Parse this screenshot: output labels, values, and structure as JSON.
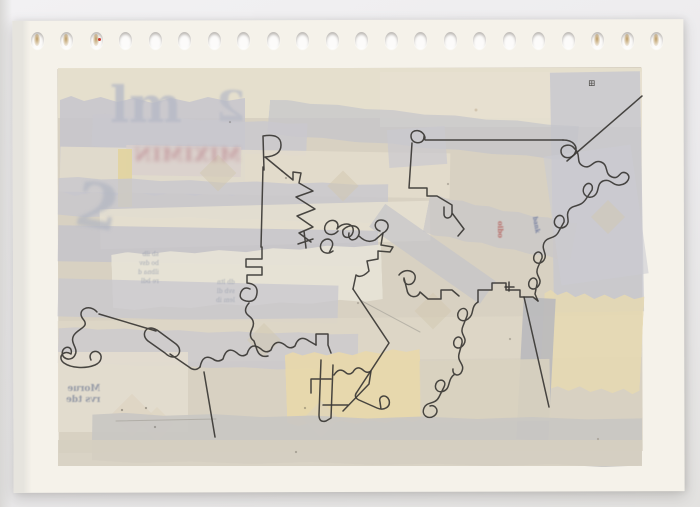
{
  "photo": {
    "bg_top": "#f2f1f3",
    "bg_bottom": "#e3e2e0"
  },
  "sheet": {
    "x": 13,
    "y": 20,
    "w": 671,
    "h": 472,
    "color": "#f5f2ea",
    "band_x": 0,
    "band_w": 18
  },
  "perforations": {
    "count": 22,
    "cx0": 37,
    "cy": 40,
    "dx": 29.5,
    "rx": 6.5,
    "ry": 8.5,
    "stained": [
      0,
      1,
      2,
      19,
      20,
      21
    ],
    "red_dot_index": 2
  },
  "collage": {
    "patches": [
      {
        "x": 58,
        "y": 68,
        "w": 584,
        "h": 384,
        "rot": -0.2,
        "c": "#d8d1c2",
        "o": 1,
        "base": true
      },
      {
        "x": 58,
        "y": 68,
        "w": 584,
        "h": 50,
        "rot": 0,
        "c": "#e6dfce",
        "o": 0.95
      },
      {
        "x": 60,
        "y": 96,
        "w": 185,
        "h": 100,
        "rot": 0,
        "c": "#c7c6cc",
        "o": 0.85,
        "torn": true
      },
      {
        "x": 380,
        "y": 72,
        "w": 262,
        "h": 55,
        "rot": 0,
        "c": "#e7e0d0",
        "o": 0.9
      },
      {
        "x": 552,
        "y": 72,
        "w": 90,
        "h": 240,
        "rot": -1,
        "c": "#c7c7ce",
        "o": 0.8
      },
      {
        "x": 268,
        "y": 112,
        "w": 310,
        "h": 36,
        "rot": 5,
        "c": "#c4c4cb",
        "o": 0.7,
        "torn": true
      },
      {
        "x": 92,
        "y": 118,
        "w": 215,
        "h": 34,
        "rot": 2.5,
        "c": "#c9c8ce",
        "o": 0.8,
        "torn": true
      },
      {
        "x": 60,
        "y": 150,
        "w": 390,
        "h": 45,
        "rot": 1,
        "c": "#e4ddcc",
        "o": 0.85
      },
      {
        "x": 126,
        "y": 146,
        "w": 115,
        "h": 30,
        "rot": 1,
        "c": "#d9d0cc",
        "o": 0.85
      },
      {
        "x": 118,
        "y": 149,
        "w": 14,
        "h": 58,
        "rot": 0,
        "c": "#e2d4a0",
        "o": 0.95
      },
      {
        "x": 58,
        "y": 180,
        "w": 330,
        "h": 40,
        "rot": 1.2,
        "c": "#c8c7cd",
        "o": 0.8,
        "torn": true
      },
      {
        "x": 100,
        "y": 205,
        "w": 330,
        "h": 40,
        "rot": -1.5,
        "c": "#e6e0d1",
        "o": 0.85
      },
      {
        "x": 388,
        "y": 128,
        "w": 58,
        "h": 38,
        "rot": -4,
        "c": "#cac9cf",
        "o": 0.7
      },
      {
        "x": 58,
        "y": 228,
        "w": 320,
        "h": 36,
        "rot": 1,
        "c": "#c4c3ca",
        "o": 0.8
      },
      {
        "x": 425,
        "y": 208,
        "w": 150,
        "h": 40,
        "rot": 11,
        "c": "#cbc8c8",
        "o": 0.8,
        "torn": true
      },
      {
        "x": 552,
        "y": 150,
        "w": 88,
        "h": 130,
        "rot": -8,
        "c": "#ccccd2",
        "o": 0.6
      },
      {
        "x": 112,
        "y": 248,
        "w": 270,
        "h": 58,
        "rot": -2,
        "c": "#e8e3d7",
        "o": 0.9,
        "torn": true
      },
      {
        "x": 58,
        "y": 282,
        "w": 280,
        "h": 38,
        "rot": 1.5,
        "c": "#c8c7cd",
        "o": 0.75
      },
      {
        "x": 365,
        "y": 240,
        "w": 135,
        "h": 28,
        "rot": 35,
        "c": "#c5c4c9",
        "o": 0.7
      },
      {
        "x": 58,
        "y": 318,
        "w": 584,
        "h": 42,
        "rot": -0.6,
        "c": "#ded7c7",
        "o": 0.85
      },
      {
        "x": 58,
        "y": 330,
        "w": 300,
        "h": 38,
        "rot": 1.2,
        "c": "#c9c8ce",
        "o": 0.7,
        "torn": true
      },
      {
        "x": 286,
        "y": 350,
        "w": 135,
        "h": 74,
        "rot": -2,
        "c": "#e9d8ab",
        "o": 0.9,
        "torn": true
      },
      {
        "x": 542,
        "y": 292,
        "w": 100,
        "h": 100,
        "rot": 3,
        "c": "#e6d9b1",
        "o": 0.85,
        "torn": true
      },
      {
        "x": 520,
        "y": 298,
        "w": 32,
        "h": 142,
        "rot": 3,
        "c": "#b9b9bd",
        "o": 0.9
      },
      {
        "x": 58,
        "y": 352,
        "w": 130,
        "h": 80,
        "rot": 0,
        "c": "#e3ddcf",
        "o": 0.9
      },
      {
        "x": 420,
        "y": 360,
        "w": 130,
        "h": 62,
        "rot": -1,
        "c": "#d9d2c0",
        "o": 0.85
      },
      {
        "x": 205,
        "y": 160,
        "w": 26,
        "h": 26,
        "rot": 45,
        "c": "#d2c7b0",
        "o": 0.5
      },
      {
        "x": 332,
        "y": 175,
        "w": 22,
        "h": 22,
        "rot": 45,
        "c": "#d2c7b0",
        "o": 0.5
      },
      {
        "x": 252,
        "y": 328,
        "w": 24,
        "h": 24,
        "rot": 45,
        "c": "#d2c7b0",
        "o": 0.5
      },
      {
        "x": 420,
        "y": 298,
        "w": 26,
        "h": 26,
        "rot": 45,
        "c": "#d2c7b0",
        "o": 0.5
      },
      {
        "x": 596,
        "y": 205,
        "w": 24,
        "h": 24,
        "rot": 45,
        "c": "#d2c7b0",
        "o": 0.5
      },
      {
        "x": 117,
        "y": 400,
        "w": 30,
        "h": 30,
        "rot": 45,
        "c": "#ddd3c0",
        "o": 0.65
      },
      {
        "x": 145,
        "y": 412,
        "w": 24,
        "h": 24,
        "rot": 45,
        "c": "#ddd3c0",
        "o": 0.6
      },
      {
        "x": 308,
        "y": 406,
        "w": 26,
        "h": 26,
        "rot": 45,
        "c": "#ddd3c0",
        "o": 0.55
      },
      {
        "x": 92,
        "y": 415,
        "w": 550,
        "h": 50,
        "rot": 0.5,
        "c": "#c9c6c3",
        "o": 0.9,
        "torn": true
      },
      {
        "x": 58,
        "y": 440,
        "w": 584,
        "h": 26,
        "rot": 0,
        "c": "#d6cfc1",
        "o": 0.9
      }
    ]
  },
  "ghost_texts": [
    {
      "text": "lm",
      "x": 110,
      "y": 80,
      "size": 50,
      "color": "#b7bac6",
      "blur": 1,
      "mirror": false,
      "rot": 0,
      "bold": true,
      "o": 0.8
    },
    {
      "text": "2",
      "x": 216,
      "y": 86,
      "size": 42,
      "color": "#b7bac6",
      "blur": 1,
      "mirror": true,
      "rot": 0,
      "bold": true,
      "o": 0.7
    },
    {
      "text": "2",
      "x": 76,
      "y": 176,
      "size": 62,
      "color": "#b3b7c2",
      "blur": 1.5,
      "mirror": false,
      "rot": 10,
      "bold": true,
      "o": 0.75
    },
    {
      "text": "MIXIMIN",
      "x": 133,
      "y": 146,
      "size": 19,
      "color": "#c2969b",
      "blur": 2,
      "mirror": true,
      "rot": 0,
      "bold": true,
      "ls": 1,
      "o": 0.85
    },
    {
      "text": "sb ilb\nbo dsv\nilbna d\nre bdl",
      "x": 138,
      "y": 250,
      "size": 6,
      "color": "#9aa0ae",
      "blur": 0.4,
      "mirror": true,
      "rot": 0,
      "bold": false,
      "lh": 1.5,
      "o": 0.85
    },
    {
      "text": "db ltn\nsvb dl\nlem ib",
      "x": 216,
      "y": 278,
      "size": 6,
      "color": "#9aa0ae",
      "blur": 0.4,
      "mirror": true,
      "rot": 0,
      "bold": false,
      "lh": 1.5,
      "o": 0.8
    },
    {
      "text": "Morue\nrvs tde",
      "x": 66,
      "y": 384,
      "size": 9,
      "color": "#8d93a2",
      "blur": 0.4,
      "mirror": true,
      "rot": 0,
      "bold": true,
      "lh": 1.2,
      "o": 0.9
    },
    {
      "text": "oibo",
      "x": 492,
      "y": 226,
      "size": 7,
      "color": "#b3544f",
      "blur": 0.5,
      "mirror": false,
      "rot": 90,
      "bold": true,
      "o": 0.8
    },
    {
      "text": "bank",
      "x": 527,
      "y": 222,
      "size": 6,
      "color": "#5f6c96",
      "blur": 0.5,
      "mirror": false,
      "rot": 80,
      "bold": true,
      "o": 0.8
    },
    {
      "text": "⊞",
      "x": 588,
      "y": 80,
      "size": 9,
      "color": "#44423e",
      "blur": 0,
      "mirror": false,
      "rot": 0,
      "bold": false,
      "o": 0.9
    }
  ],
  "ink": {
    "color": "#3a3734",
    "width": 1.5,
    "paths": [
      "M642,96 L567,161",
      "M425,138 C424,129 411,128 411,136 C411,145 425,145 424,136 L425,140 L563,140",
      "M563,140 C574,140 578,147 575,153 C572,160 561,159 561,151 C561,145 570,143 574,148 C582,155 575,162 583,166 C591,170 593,159 601,162 C609,165 604,174 612,177 C620,180 619,170 626,173 C632,176 628,184 620,185 C612,186 611,178 603,181 C596,184 600,192 594,196 C588,200 581,194 584,187 C587,181 594,183 592,190 L586,199 C580,208 573,204 569,210 C565,216 571,221 566,226 C560,231 552,226 555,219 C558,213 565,215 564,222 L559,231 C555,240 547,236 544,243 C541,250 548,254 544,260 C540,266 532,263 534,256 C536,250 543,251 542,258 L538,267 C534,276 543,278 539,285 C535,292 527,289 529,282 C531,276 538,277 537,284 L535,294 L538,301",
      "M478,302 V290 H492 V283 H506 V290 H520 V297 H533 L538,301",
      "M509,282 V291 M505,287 H514",
      "M524,297 L549,407",
      "M478,302 C470,307 475,314 468,319 C461,324 455,317 459,311 C463,306 469,309 467,316 L463,326 C459,335 468,337 464,344 C460,351 452,348 454,341 C456,335 463,336 462,343 L459,354 C457,362 465,364 462,371 C460,377 452,376 453,369 M455,374 C447,379 451,388 444,391 C437,394 433,387 437,382 C441,378 447,381 444,387 L439,397 C435,405 427,401 424,408 C421,415 428,420 434,416 C440,412 436,404 430,406",
      "M399,275 C405,267 417,271 415,279 C413,287 403,286 404,278 L407,290 C408,298 418,299 420,292 L428,299 H441 V290 H452 L459,296",
      "M333,251 C325,257 317,249 322,242 C327,236 335,240 332,247 L329,253 M338,231 C331,239 321,232 326,224 C331,217 341,221 337,229 C343,221 355,223 353,232 C351,240 341,239 343,230 C349,223 361,225 359,234 C357,242 347,242 349,233 M359,236 Q367,244 375,240 L383,233 C391,229 389,220 381,220 C374,220 373,229 380,231",
      "M383,233 L381,245 L393,247 L390,252 L378,251 V259 L367,261 L369,271 Q361,279 356,275 L353,289",
      "M353,289 L389,343 L357,392 Q353,397 359,400 L377,408 C384,411 391,407 389,400 C387,394 378,395 380,402 L381,409",
      "M97,312 C89,303 76,310 83,319 C90,327 79,328 74,335 C69,343 79,348 75,355 C71,363 59,358 63,350 C66,345 73,347 71,354 M71,354 C63,349 57,358 64,363 C71,368 85,369 95,365 C102,362 103,355 98,352 C93,350 88,354 91,360",
      "M99,314 L156,331 M157,330 L176,344 C182,349 180,357 173,357 C170,357 167,355 165,353 L148,341 C142,336 144,328 151,328 C153,328 155,329 157,330 M170,354 L189,367 Q195,372 200,367",
      "M200,367 Q203,353 213,359 Q218,363 223,359 Q227,345 237,353 Q242,358 247,354 Q251,341 261,349 Q266,354 271,350 Q275,338 285,345 Q290,350 295,346 Q299,334 309,341 L316,345",
      "M316,345 V334 H328 V345 L331,353 M321,360 L319,415 Q319,423 326,421 L331,418 L333,365 M311,379 H331 M311,379 V393",
      "M334,375 Q339,367 345,372 Q349,376 353,372 Q357,365 363,370 Q367,374 371,371 L369,384 L343,411 M323,405 H348",
      "M262,247 V259 H246 V267 H262 V275 H247 V283 M247,283 Q258,284 257,293 Q256,303 246,301 Q238,299 241,292 Q244,286 250,289 M249,303 Q242,311 249,316 Q256,321 252,329 Q248,337 254,341 L257,350 Q260,358 268,356",
      "M264,170 L263,136 Q281,133 281,145 Q281,156 265,157 L282,171",
      "M263,167 L261,247",
      "M282,171 L293,180 V172 L301,173 L299,183 L313,191 L296,197 L315,209 L297,216 L313,227 L299,233 L311,242 M298,244 L313,239 M304,231 L306,248",
      "M412,143 L409,188 M409,188 H427 V196 H437 L452,205 V213 C452,219 444,220 444,214 V207 M452,213 L464,229 L458,236",
      "M204,372 L215,437"
    ],
    "pencil": {
      "color": "#a09d94",
      "width": 1,
      "opacity": 0.6,
      "paths": [
        "M116,421 L216,419",
        "M360,300 L420,332"
      ]
    }
  }
}
